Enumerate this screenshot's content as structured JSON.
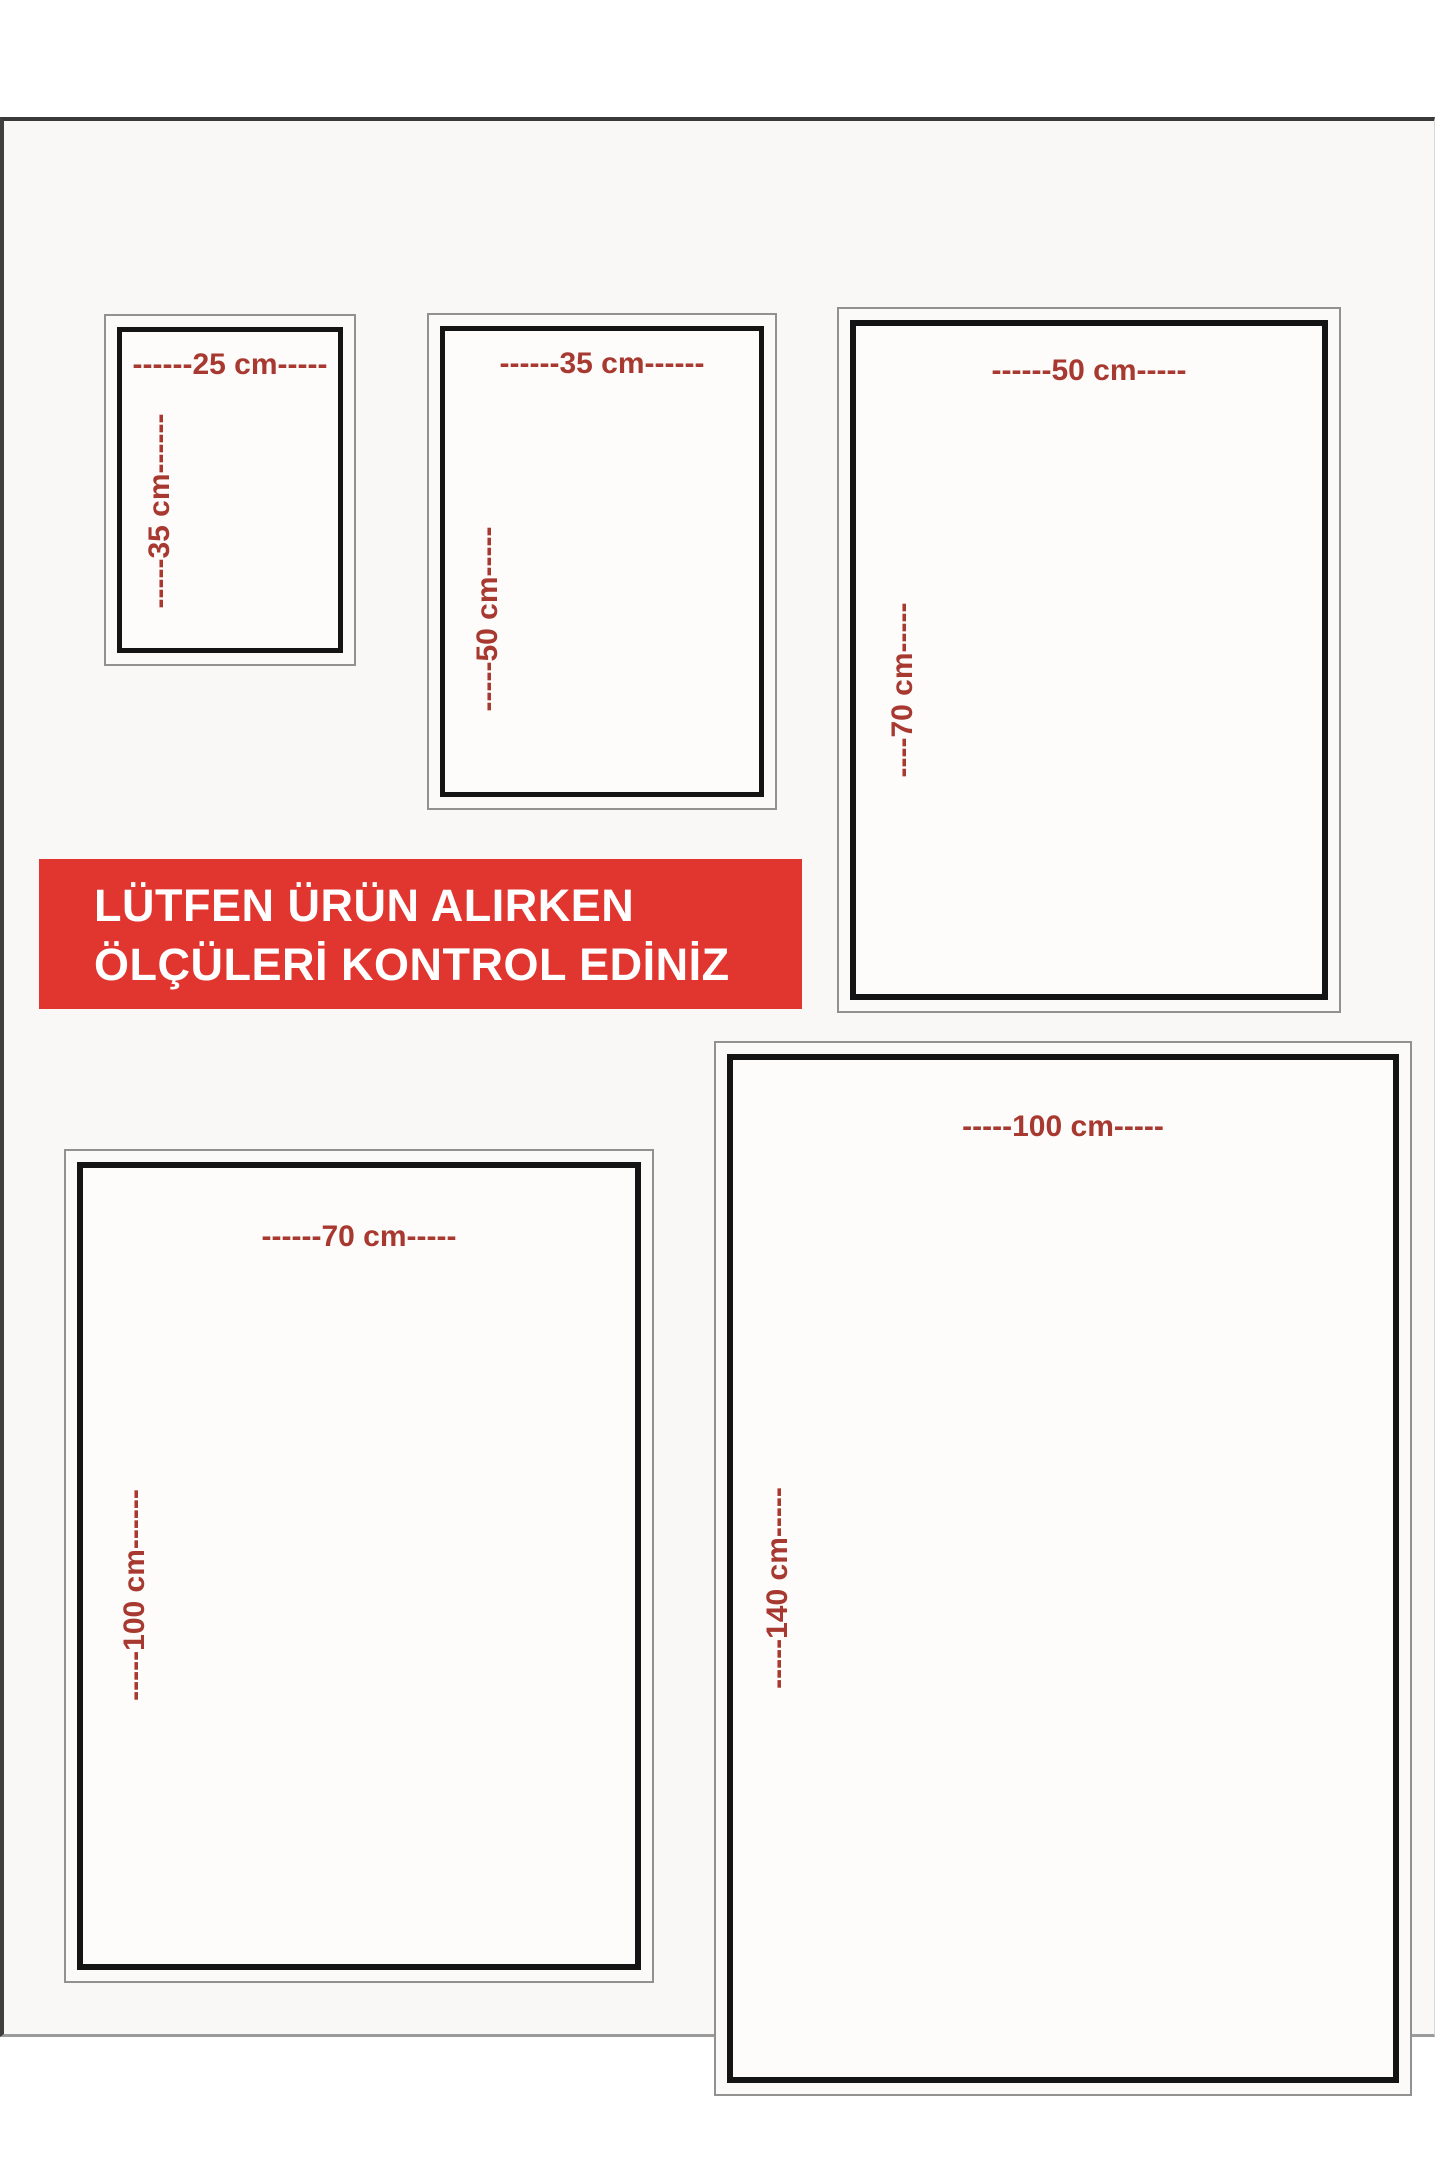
{
  "banner": {
    "line1": "LÜTFEN ÜRÜN ALIRKEN",
    "line2": "ÖLÇÜLERİ KONTROL EDİNİZ",
    "background_color": "#e13630",
    "text_color": "#ffffff"
  },
  "colors": {
    "dimension_text": "#a73930",
    "outer_frame_border": "#919191",
    "inner_frame_border": "#141414",
    "canvas_background": "#f9f8f6"
  },
  "sizes": [
    {
      "name": "25x35",
      "width_cm": 25,
      "height_cm": 35,
      "width_label": "------25 cm-----",
      "height_label": "-----35 cm------"
    },
    {
      "name": "35x50",
      "width_cm": 35,
      "height_cm": 50,
      "width_label": "------35 cm------",
      "height_label": "-----50 cm-----"
    },
    {
      "name": "50x70",
      "width_cm": 50,
      "height_cm": 70,
      "width_label": "------50 cm-----",
      "height_label": "----70 cm-----"
    },
    {
      "name": "70x100",
      "width_cm": 70,
      "height_cm": 100,
      "width_label": "------70 cm-----",
      "height_label": "-----100 cm------"
    },
    {
      "name": "100x140",
      "width_cm": 100,
      "height_cm": 140,
      "width_label": "-----100 cm-----",
      "height_label": "-----140 cm-----"
    }
  ]
}
